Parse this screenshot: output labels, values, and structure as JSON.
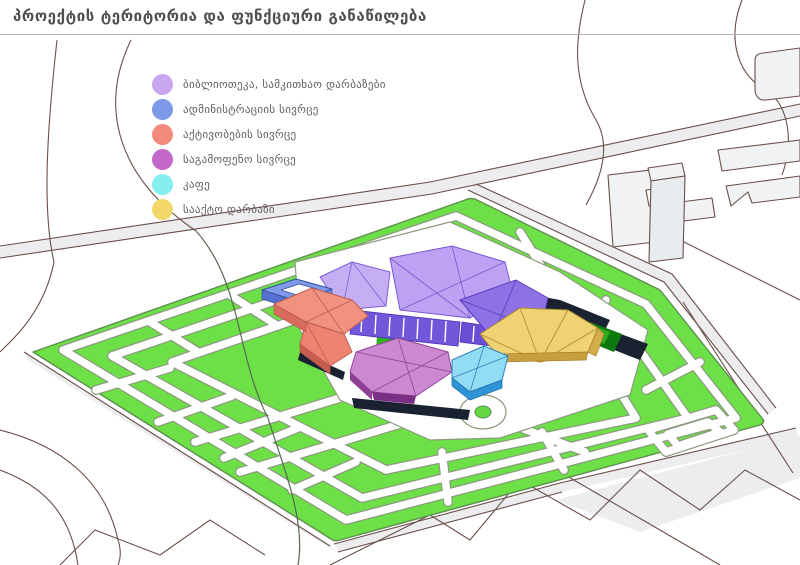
{
  "title": "პროექტის ტერიტორია და ფუნქციური განაწილება",
  "legend": {
    "items": [
      {
        "label": "ბიბლიოთეკა, სამკითხაო დარბაზები",
        "color": "#c9a7f0"
      },
      {
        "label": "ადმინისტრაციის სივრცე",
        "color": "#7e99e8"
      },
      {
        "label": "აქტივობების სივრცე",
        "color": "#f38b7c"
      },
      {
        "label": "საგამოფენო სივრცე",
        "color": "#c268c8"
      },
      {
        "label": "კაფე",
        "color": "#85eff0"
      },
      {
        "label": "სააქტო დარბაზი",
        "color": "#f2d76a"
      }
    ]
  },
  "map": {
    "lawn_color": "#6ce046",
    "path_color": "#ffffff",
    "road_line_color": "#6a4f49",
    "dark_mass_color": "#1a2130"
  }
}
